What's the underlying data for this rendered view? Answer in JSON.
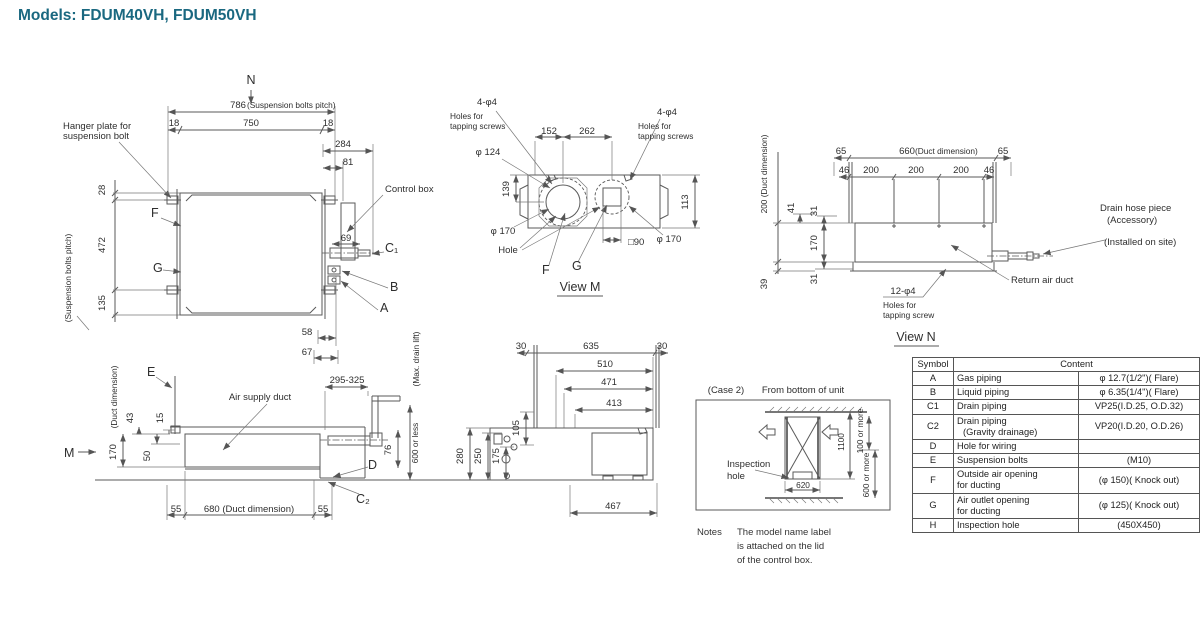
{
  "title": "Models: FDUM40VH, FDUM50VH",
  "colors": {
    "accent": "#1a6880",
    "line": "#5a5a5a"
  },
  "plan": {
    "n": "N",
    "d786": "786",
    "d786_note": "(Suspension bolts pitch)",
    "d18l": "18",
    "d750": "750",
    "d18r": "18",
    "d284": "284",
    "d81": "81",
    "hanger1": "Hanger plate for",
    "hanger2": "suspension bolt",
    "d28": "28",
    "d472": "472",
    "d135": "135",
    "pitch_v": "(Suspension bolts pitch)",
    "f": "F",
    "g": "G",
    "control_box": "Control box",
    "d69": "69",
    "c1": "C₁",
    "b": "B",
    "a": "A",
    "d58": "58",
    "d67": "67"
  },
  "view_m": {
    "tapl": "4-φ4",
    "tapl1": "Holes for",
    "tapl2": "tapping screws",
    "tapr": "4-φ4",
    "tapr1": "Holes for",
    "tapr2": "tapping screws",
    "d152": "152",
    "d262": "262",
    "d124": "φ 124",
    "d139": "139",
    "d113": "113",
    "d170l": "φ 170",
    "d170r": "φ 170",
    "hole": "Hole",
    "f": "F",
    "g": "G",
    "d90": "□90",
    "title": "View M"
  },
  "view_n": {
    "duct200": "200 (Duct dimension)",
    "d65l": "65",
    "d660": "660",
    "d660_note": "(Duct dimension)",
    "d65r": "65",
    "d46l": "46",
    "d200a": "200",
    "d200b": "200",
    "d200c": "200",
    "d46r": "46",
    "d41": "41",
    "d31a": "31",
    "d170": "170",
    "d31b": "31",
    "d39": "39",
    "tap": "12-φ4",
    "tap1": "Holes for",
    "tap2": "tapping screw",
    "return_duct": "Return air duct",
    "drain1": "Drain hose piece",
    "drain2": "(Accessory)",
    "drain3": "(Installed on site)",
    "title": "View N"
  },
  "side": {
    "e": "E",
    "duct_note": "(Duct dimension)",
    "d43": "43",
    "d15": "15",
    "m": "M",
    "d170": "170",
    "d50": "50",
    "air_supply": "Air supply duct",
    "d295": "295-325",
    "max_drain": "(Max. drain lift)",
    "d600": "600 or less",
    "d76": "76",
    "d": "D",
    "c2": "C₂",
    "d55l": "55",
    "d680": "680 (Duct dimension)",
    "d55r": "55"
  },
  "bottom": {
    "d30l": "30",
    "d635": "635",
    "d30r": "30",
    "d510": "510",
    "d471": "471",
    "d413": "413",
    "d105": "105",
    "d175": "175",
    "d250": "250",
    "d280": "280",
    "d467": "467"
  },
  "case2": {
    "label": "(Case 2)",
    "from": "From bottom of unit",
    "insp1": "Inspection",
    "insp2": "hole",
    "d1100": "1100",
    "d100": "100 or more",
    "d600": "600 or more",
    "d620": "620"
  },
  "notes": {
    "label": "Notes",
    "l1": "The model name label",
    "l2": "is attached on the lid",
    "l3": "of the control box."
  },
  "table": {
    "h_symbol": "Symbol",
    "h_content": "Content",
    "rows": [
      {
        "s": "A",
        "n": "Gas piping",
        "n2": "",
        "v": "φ 12.7(1/2\")( Flare)"
      },
      {
        "s": "B",
        "n": "Liquid piping",
        "n2": "",
        "v": "φ 6.35(1/4\")( Flare)"
      },
      {
        "s": "C1",
        "n": "Drain piping",
        "n2": "",
        "v": "VP25(I.D.25, O.D.32)"
      },
      {
        "s": "C2",
        "n": "Drain piping",
        "n2": "(Gravity drainage)",
        "v": "VP20(I.D.20, O.D.26)"
      },
      {
        "s": "D",
        "n": "Hole for wiring",
        "n2": "",
        "v": ""
      },
      {
        "s": "E",
        "n": "Suspension bolts",
        "n2": "",
        "v": "(M10)"
      },
      {
        "s": "F",
        "n": "Outside air opening",
        "n2": "for ducting",
        "v": "(φ 150)( Knock out)"
      },
      {
        "s": "G",
        "n": "Air outlet opening",
        "n2": "for ducting",
        "v": "(φ 125)( Knock out)"
      },
      {
        "s": "H",
        "n": "Inspection hole",
        "n2": "",
        "v": "(450X450)"
      }
    ]
  }
}
